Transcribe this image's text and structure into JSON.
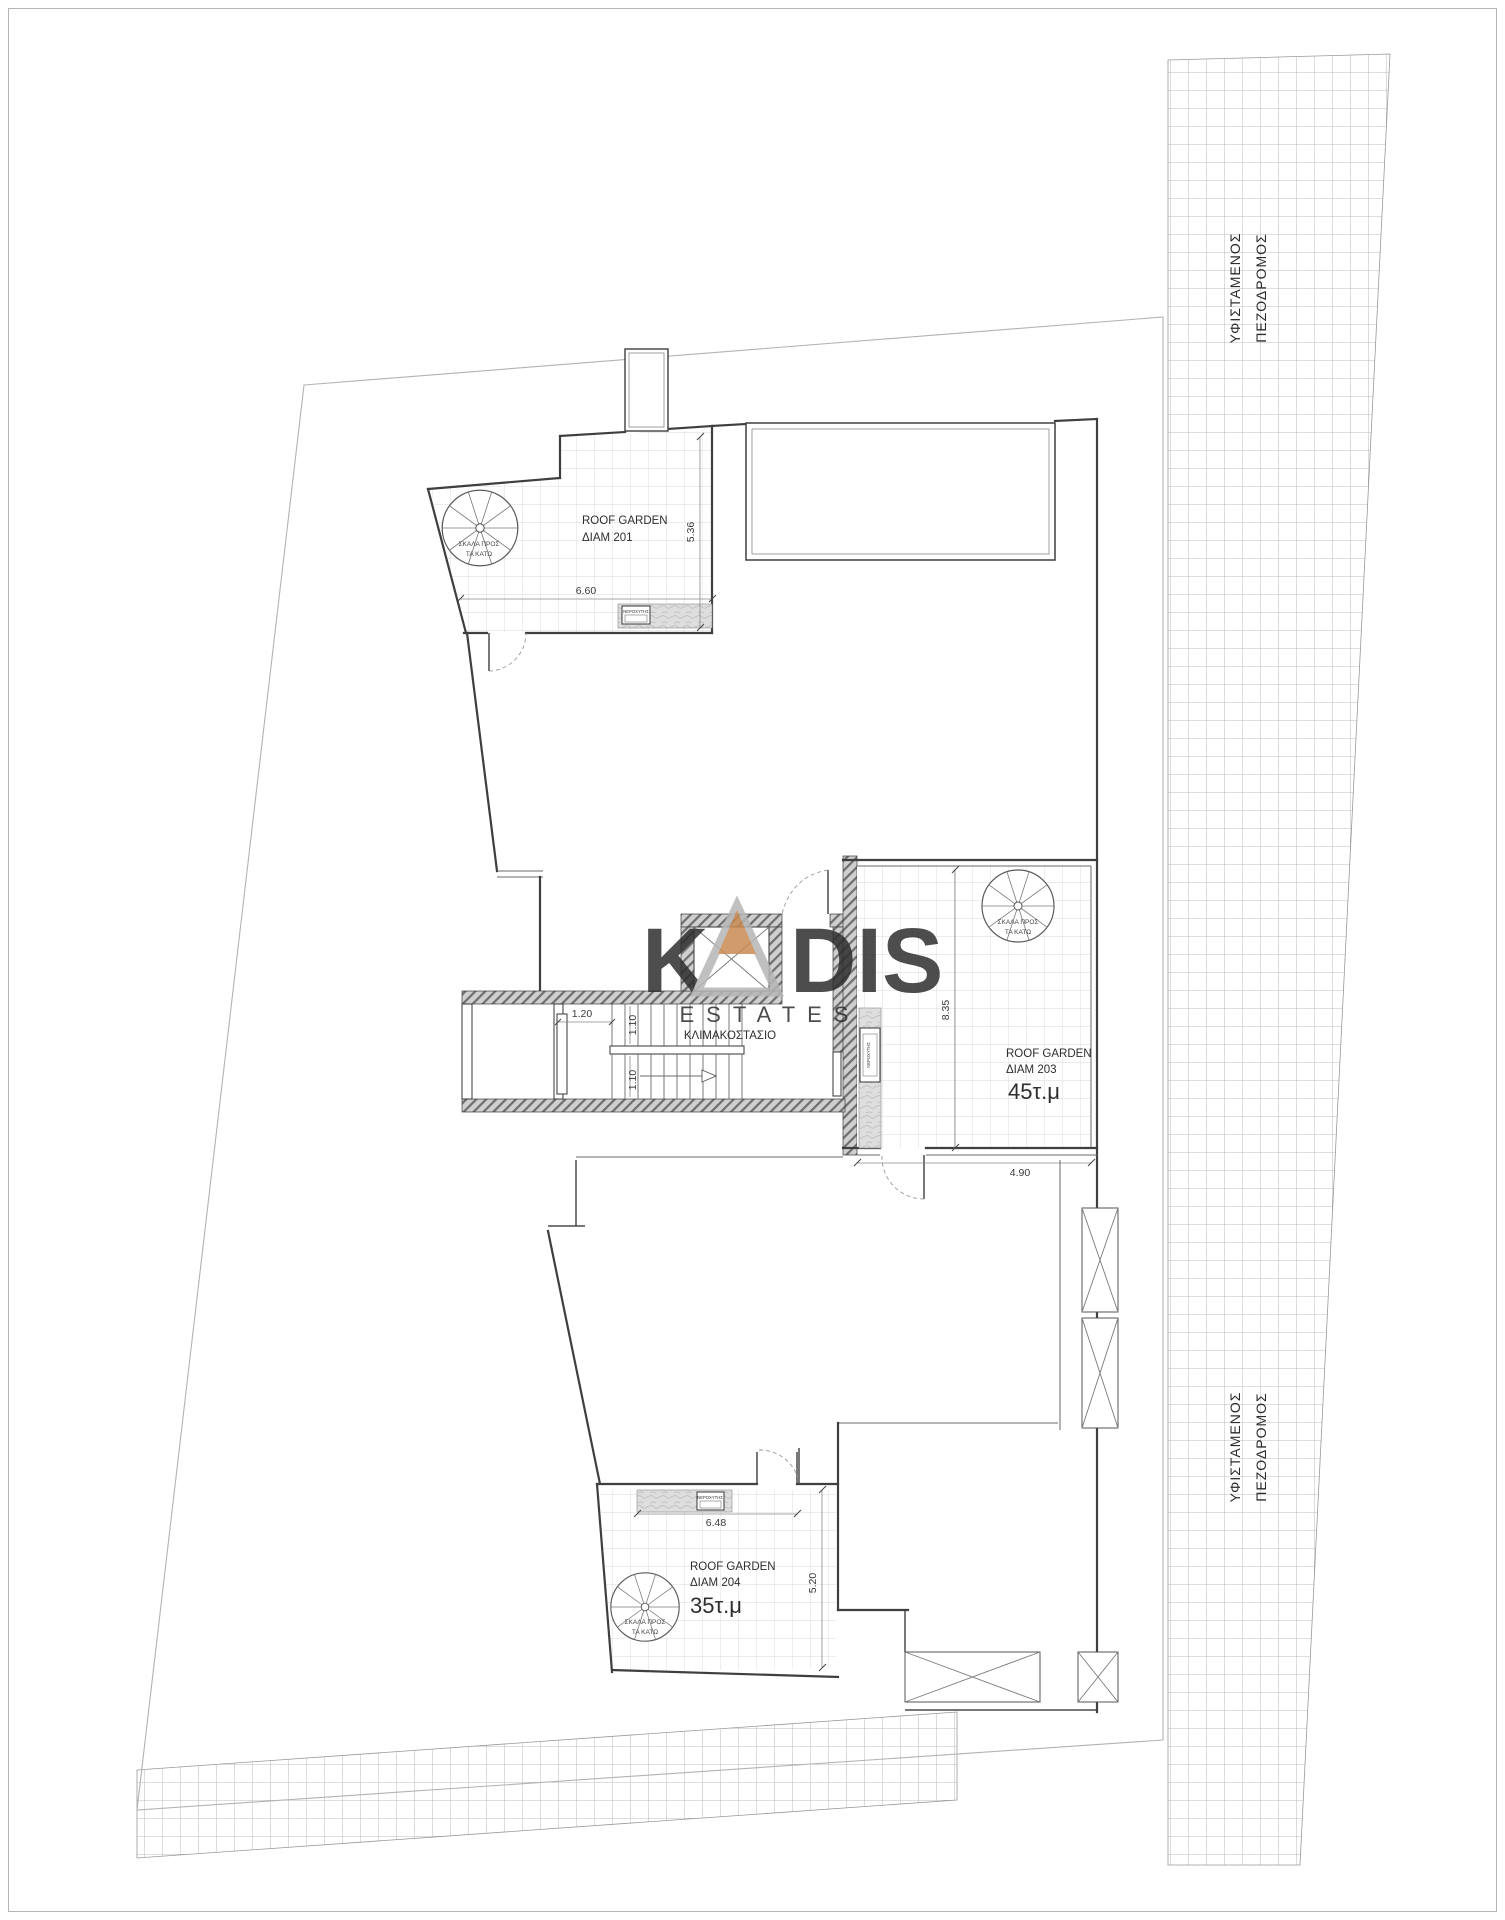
{
  "drawing": {
    "streets": {
      "right_top": {
        "line1": "ΥΦΙΣΤΑΜΕΝΟΣ",
        "line2": "ΠΕΖΟΔΡΟΜΟΣ"
      },
      "right_bottom": {
        "line1": "ΥΦΙΣΤΑΜΕΝΟΣ",
        "line2": "ΠΕΖΟΔΡΟΜΟΣ"
      }
    },
    "units": {
      "u201": {
        "title": "ROOF GARDEN",
        "name": "ΔΙΑΜ 201"
      },
      "u203": {
        "title": "ROOF GARDEN",
        "name": "ΔΙΑΜ 203",
        "area": "45τ.μ"
      },
      "u204": {
        "title": "ROOF GARDEN",
        "name": "ΔΙΑΜ 204",
        "area": "35τ.μ"
      }
    },
    "core_label": "ΚΛΙΜΑΚΟΣΤΑΣΙΟ",
    "spiral_label": {
      "line1": "ΣΚΑΛΑ ΠΡΟΣ",
      "line2": "ΤΑ ΚΑΤΩ"
    },
    "fixture_label": "ΝΕΡΟΧΥΤΗΣ",
    "dims": {
      "rg201_width": "6.60",
      "rg201_height": "5.36",
      "stair_left": "1.20",
      "stair_flight_a": "1.10",
      "stair_flight_b": "1.10",
      "rg203_height": "8.35",
      "rg203_width": "4.90",
      "rg204_width": "6.48",
      "rg204_height": "5.20"
    }
  },
  "watermark": {
    "k": "K",
    "dis": "DIS",
    "sub": "ESTATES",
    "letter_color": "#b6b6b6",
    "accent_color": "#c98a52"
  }
}
